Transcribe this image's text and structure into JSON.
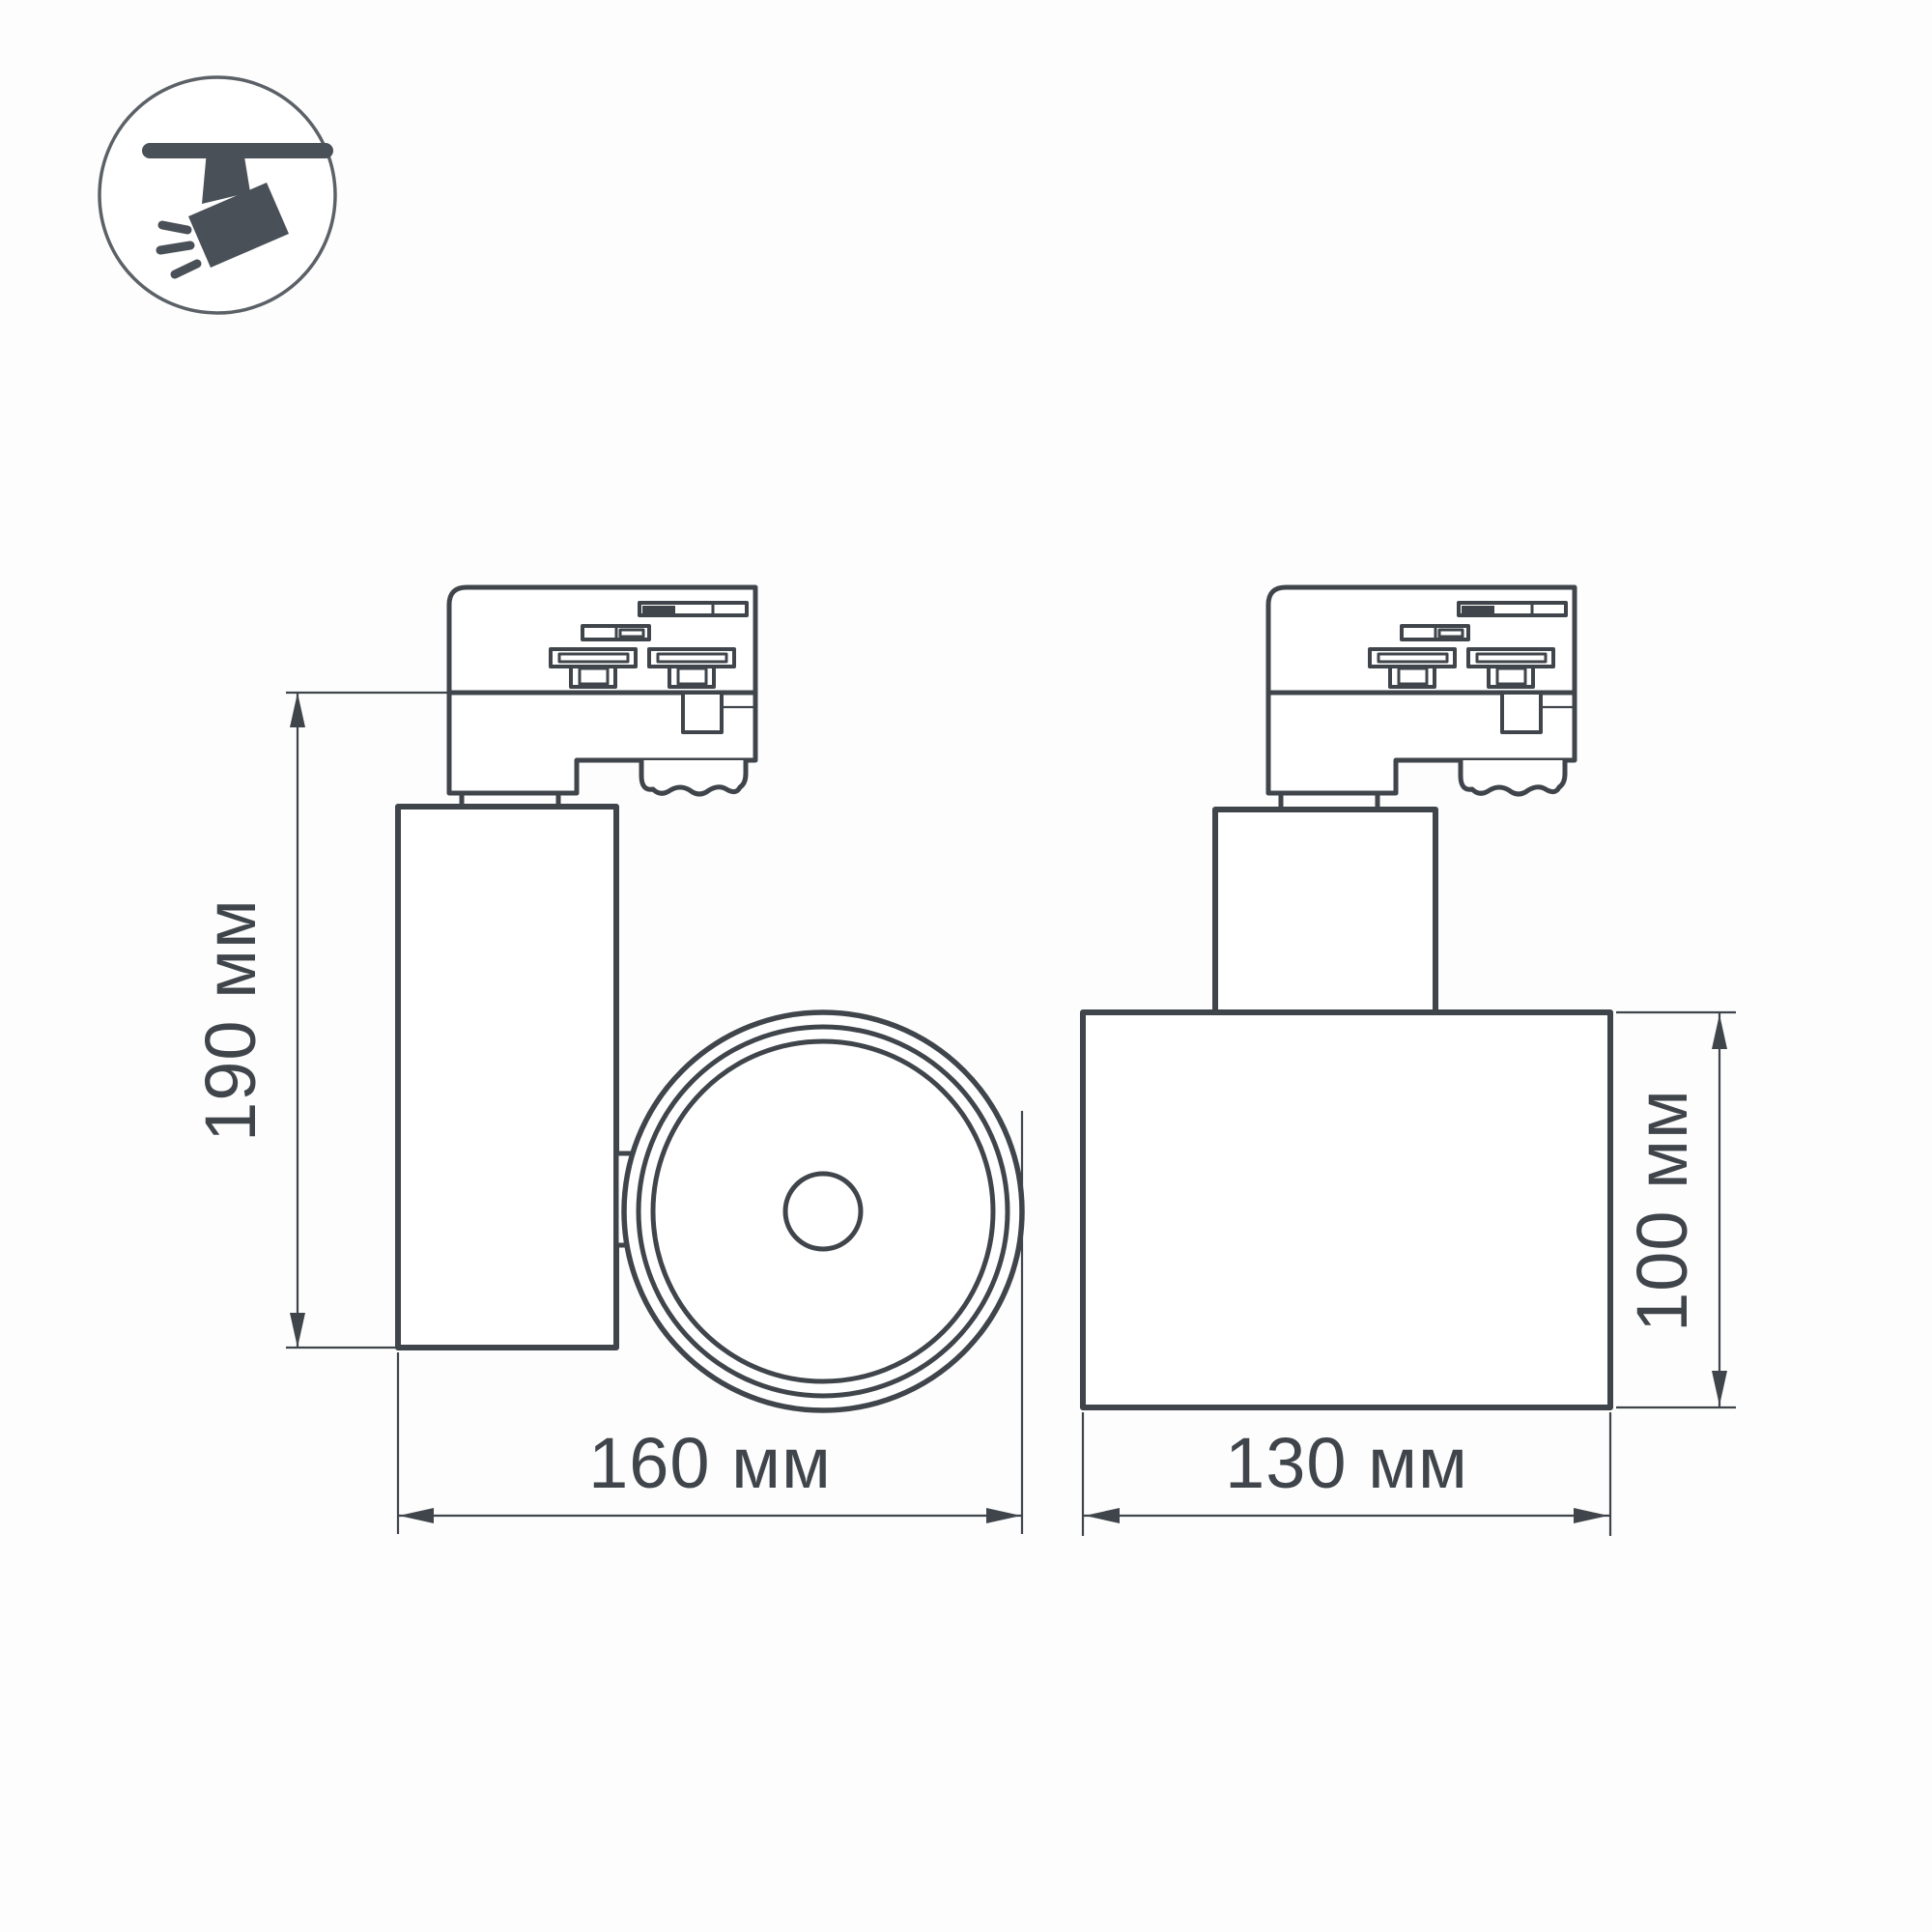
{
  "icon": {
    "name": "ceiling-track-spotlight-pictogram"
  },
  "views": {
    "side": {
      "height_label": "190 мм",
      "width_label": "160 мм"
    },
    "front": {
      "width_label": "130 мм",
      "height_label": "100 мм"
    }
  },
  "colors": {
    "line": "#3f454b",
    "text": "#3f454b",
    "icon": "#4a5057",
    "icon_ring": "#5b6167",
    "background": "#fdfdfd"
  }
}
